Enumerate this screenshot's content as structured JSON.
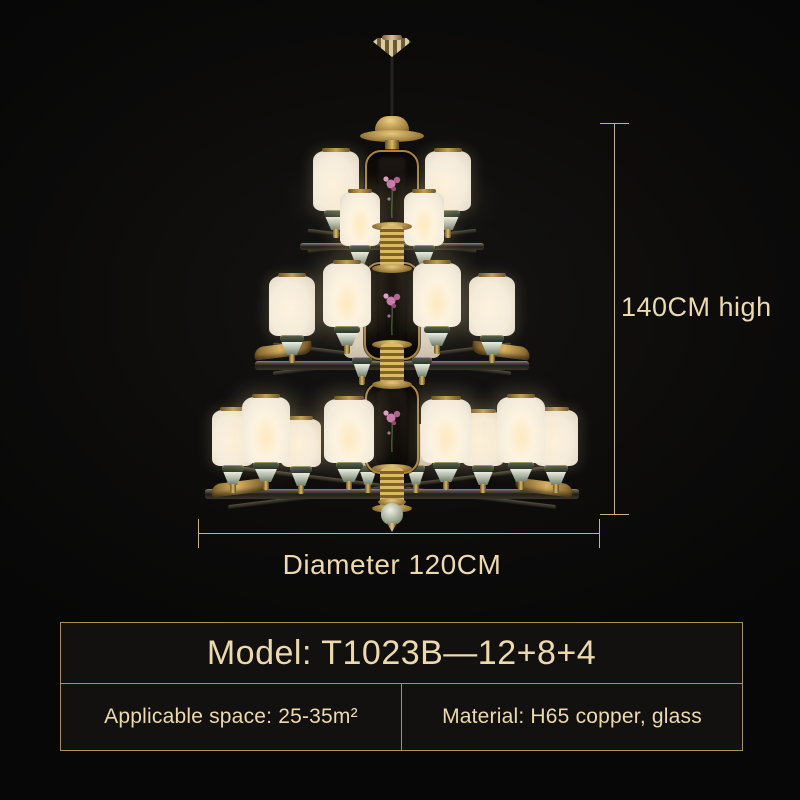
{
  "annotations": {
    "height": "140CM high",
    "diameter": "Diameter 120CM"
  },
  "info_table": {
    "model": "Model: T1023B—12+8+4",
    "applicable_space": "Applicable space: 25-35m²",
    "material": "Material: H65 copper, glass"
  },
  "colors": {
    "background": "#0d0c0b",
    "gold_line": "#c8b183",
    "cream_text": "#ecd9ae",
    "box_border": "#a7925f",
    "brass": "#d9b96a",
    "shade_white": "#f5ecdc",
    "glow_warm": "#ffe9bf",
    "flower_pink": "#c87aa8"
  }
}
